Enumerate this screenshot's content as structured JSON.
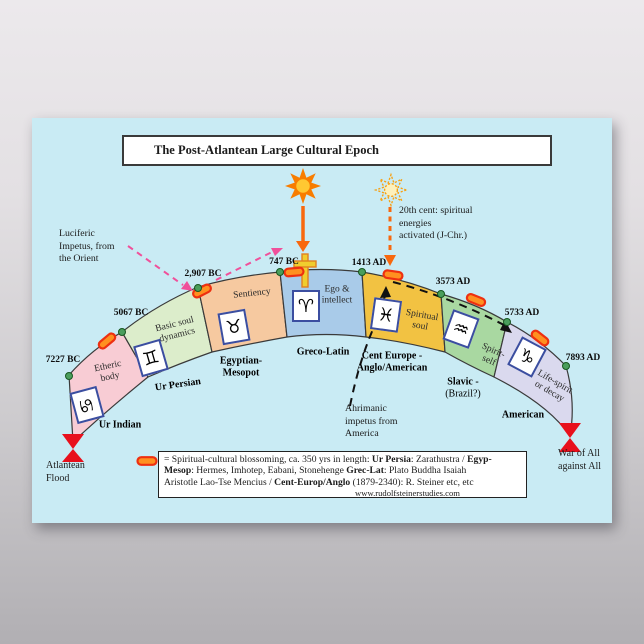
{
  "title": "The Post-Atlantean  Large Cultural Epoch",
  "epochs": [
    {
      "name1": "Ur Indian",
      "date": "7227 BC",
      "faculty1": "Etheric",
      "faculty2": "body",
      "zodiac": "♋",
      "zodiac_name": "cancer",
      "color": "#f8ccd4"
    },
    {
      "name1": "Ur Persian",
      "date": "5067 BC",
      "faculty1": "Basic soul",
      "faculty2": "dynamics",
      "zodiac": "♊",
      "zodiac_name": "gemini",
      "color": "#dcedcb"
    },
    {
      "name1": "Egyptian-",
      "name2": "Mesopot",
      "date": "2,907 BC",
      "faculty1": "Sentiency",
      "zodiac": "♉",
      "zodiac_name": "taurus",
      "color": "#f6c9a0"
    },
    {
      "name1": "Greco-Latin",
      "date": "747 BC",
      "faculty1": "Ego &",
      "faculty2": "intellect",
      "zodiac": "♈",
      "zodiac_name": "aries",
      "color": "#a9cbe9"
    },
    {
      "name1": "Cent Europe -",
      "name2": "Anglo/American",
      "date": "1413 AD",
      "faculty1": "Spiritual",
      "faculty2": "soul",
      "zodiac": "♓",
      "zodiac_name": "pisces",
      "color": "#f2c242"
    },
    {
      "name1": "Slavic -",
      "name2": "(Brazil?)",
      "date": "3573 AD",
      "faculty1": "Spirit-",
      "faculty2": "self",
      "zodiac": "♒",
      "zodiac_name": "aquarius",
      "color": "#a9d8a1"
    },
    {
      "name1": "American",
      "date": "5733 AD",
      "faculty1": "Life-spirit",
      "faculty2": "or decay",
      "zodiac": "♑",
      "zodiac_name": "capricorn",
      "color": "#dad9ee"
    }
  ],
  "end_date": "7893 AD",
  "endpoints": {
    "flood1": "Atlantean",
    "flood2": "Flood",
    "war1": "War of All",
    "war2": "against All"
  },
  "annotations": {
    "luciferic1": "Luciferic",
    "luciferic2": "Impetus, from",
    "luciferic3": "the Orient",
    "cent20_1": "20th cent: spiritual",
    "cent20_2": "energies",
    "cent20_3": "activated (J-Chr.)",
    "ahriman1": "Ahrimanic",
    "ahriman2": "impetus from",
    "ahriman3": "America"
  },
  "legend": {
    "r1": "=  Spiritual-cultural blossoming, ca. 350 yrs in length: ",
    "r2": "Ur Persia",
    "r3": ": Zarathustra / ",
    "r4": "Egyp-",
    "r5": "Mesop",
    "r6": ": Hermes, Imhotep, Eabani, Stonehenge  ",
    "r7": "Grec-Lat",
    "r8": ": Plato Buddha Isaiah",
    "r9": "Aristotle Lao-Tse Mencius / ",
    "r10": "Cent-Europ/Anglo",
    "r11": " (1879-2340): R. Steiner etc, etc",
    "url": "www.rudolfsteinerstudies.com"
  },
  "colors": {
    "poster_bg": "#c9ebf4",
    "arc_stroke": "#3a3a3a",
    "capsule_fill": "#ff9020",
    "capsule_stroke": "#ee3010",
    "dot_fill": "#4a9e5c",
    "dot_stroke": "#17571f",
    "sun_orange": "#f87d00",
    "sun_core": "#ffc832",
    "arrow_orange": "#f8680e",
    "pink_arrow": "#f0509a",
    "cross_fill": "#f0cd2e",
    "cross_stroke": "#e08020",
    "bowtie_red": "#e8101c",
    "impetus_black": "#111111"
  }
}
